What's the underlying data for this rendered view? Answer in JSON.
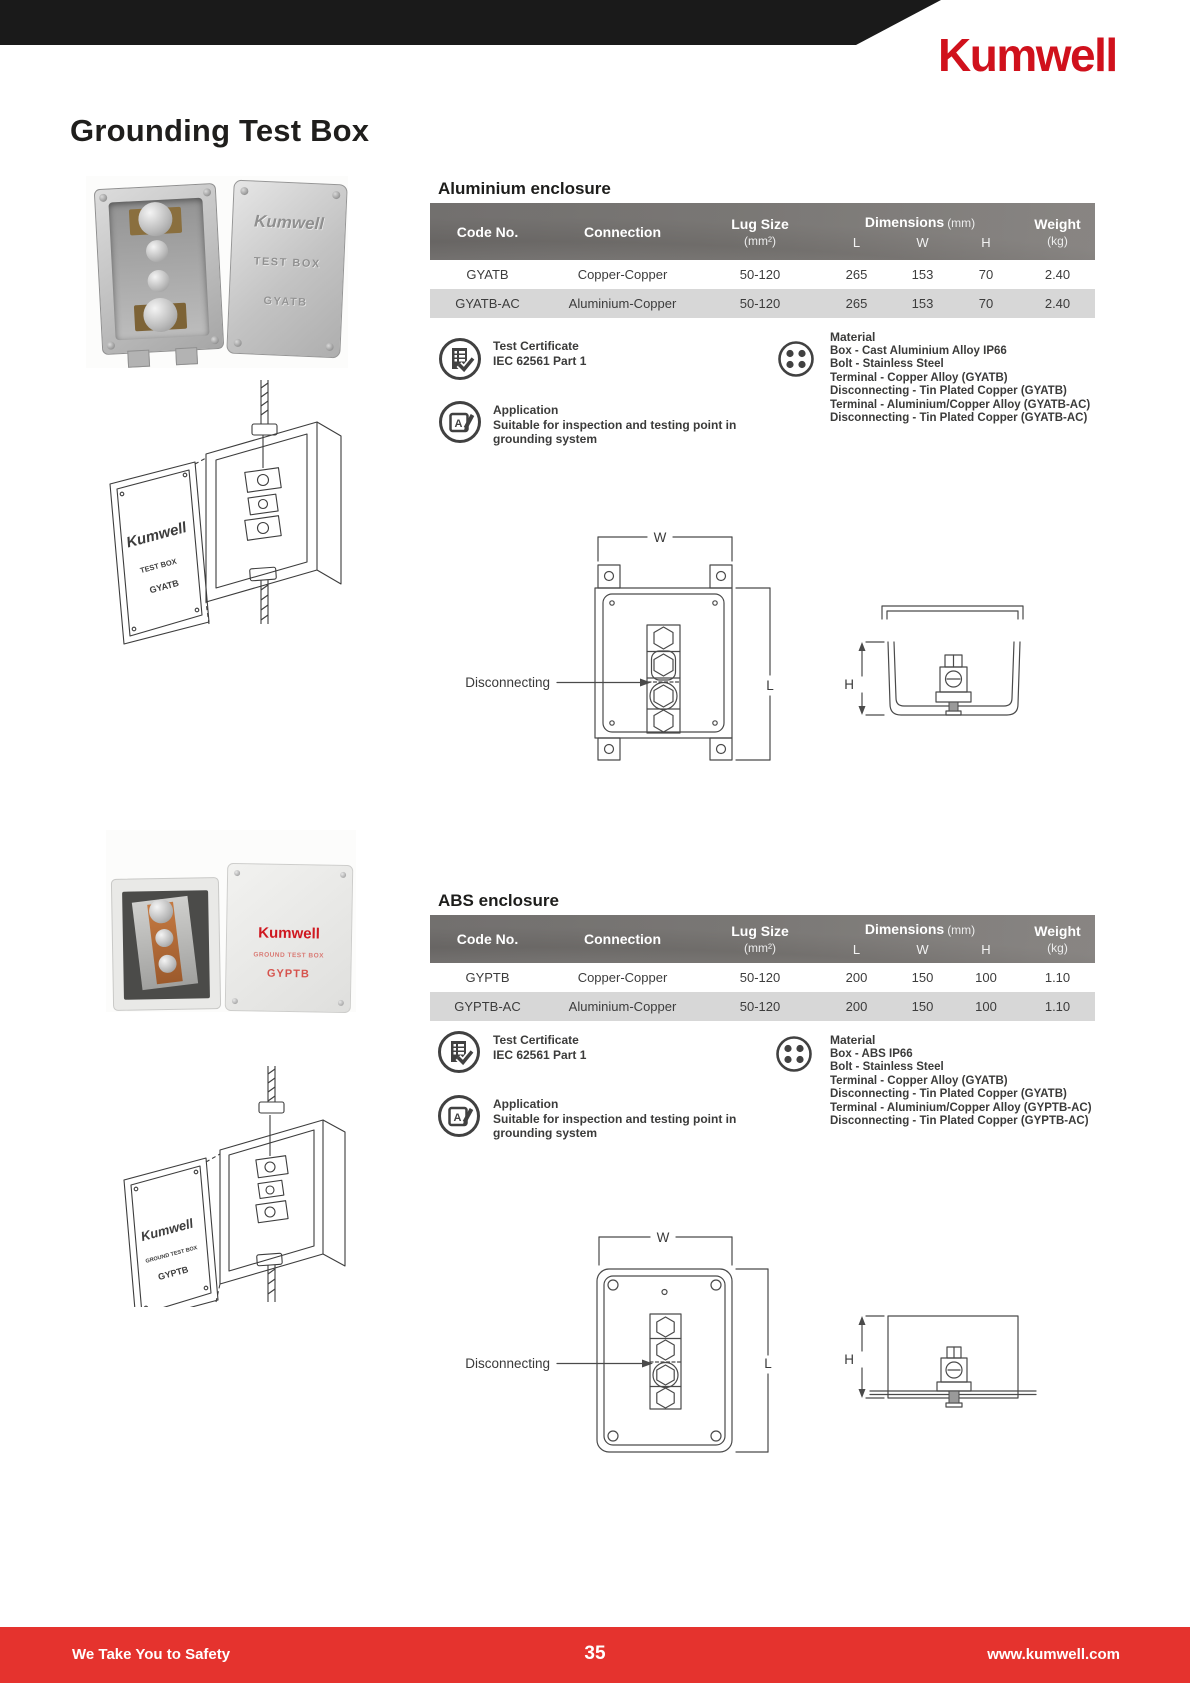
{
  "header": {
    "logo_text": "Kumwell"
  },
  "page_title": "Grounding Test Box",
  "labels": {
    "w": "W",
    "l": "L",
    "h": "H",
    "disconnecting": "Disconnecting"
  },
  "table_headers": {
    "code": "Code No.",
    "connection": "Connection",
    "lug_size": "Lug Size",
    "lug_unit": "(mm²)",
    "dimensions": "Dimensions",
    "dim_unit": "(mm)",
    "dims_sub": [
      "L",
      "W",
      "H"
    ],
    "weight": "Weight",
    "weight_unit": "(kg)"
  },
  "product_labels": {
    "aluminium": [
      "Kumwell",
      "TEST BOX",
      "GYATB"
    ],
    "abs": [
      "Kumwell",
      "GROUND TEST BOX",
      "GYPTB"
    ]
  },
  "sections": [
    {
      "heading": "Aluminium enclosure",
      "rows": [
        [
          "GYATB",
          "Copper-Copper",
          "50-120",
          "265",
          "153",
          "70",
          "2.40"
        ],
        [
          "GYATB-AC",
          "Aluminium-Copper",
          "50-120",
          "265",
          "153",
          "70",
          "2.40"
        ]
      ],
      "features": {
        "test_certificate": {
          "title": "Test Certificate",
          "line": "IEC 62561 Part 1"
        },
        "application": {
          "title": "Application",
          "line": "Suitable for inspection and testing point in grounding system"
        },
        "material": {
          "title": "Material",
          "lines": [
            "Box - Cast Aluminium Alloy IP66",
            "Bolt - Stainless Steel",
            "Terminal - Copper Alloy (GYATB)",
            "Disconnecting - Tin Plated Copper (GYATB)",
            "Terminal - Aluminium/Copper Alloy (GYATB-AC)",
            "Disconnecting - Tin Plated Copper (GYATB-AC)"
          ]
        }
      }
    },
    {
      "heading": "ABS enclosure",
      "rows": [
        [
          "GYPTB",
          "Copper-Copper",
          "50-120",
          "200",
          "150",
          "100",
          "1.10"
        ],
        [
          "GYPTB-AC",
          "Aluminium-Copper",
          "50-120",
          "200",
          "150",
          "100",
          "1.10"
        ]
      ],
      "features": {
        "test_certificate": {
          "title": "Test Certificate",
          "line": "IEC 62561 Part 1"
        },
        "application": {
          "title": "Application",
          "line": "Suitable for inspection and testing point in grounding system"
        },
        "material": {
          "title": "Material",
          "lines": [
            "Box - ABS IP66",
            "Bolt - Stainless Steel",
            "Terminal - Copper Alloy (GYATB)",
            "Disconnecting - Tin Plated Copper (GYATB)",
            "Terminal - Aluminium/Copper Alloy (GYPTB-AC)",
            "Disconnecting - Tin Plated Copper (GYPTB-AC)"
          ]
        }
      }
    }
  ],
  "footer": {
    "tagline": "We Take You to Safety",
    "page_number": "35",
    "website": "www.kumwell.com"
  }
}
